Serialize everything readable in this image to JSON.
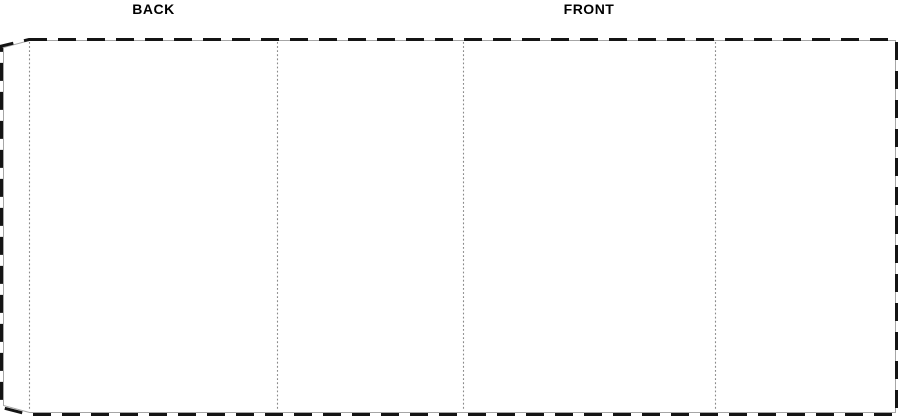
{
  "labels": {
    "back": "BACK",
    "front": "FRONT"
  },
  "colors": {
    "background": "#ffffff",
    "cut_dash": "#141414",
    "outline": "#a6a6a6",
    "fold_dots": "#8a8a8a",
    "label_text": "#000000"
  },
  "dieline": {
    "cut_path": "M29 39.5 L896.5 39.5 L896.5 414.5 L29 414.5 L1.5 407.5 L1.5 46 Z",
    "cut_dash_pattern": "18 11",
    "outline_path": "M29.5 40.5 L895.5 40.5 L895.5 412.5 L29.5 412.5 L3.5 405.5 L3.5 47.5 Z",
    "fold_dot_pattern": "1.8 2.3",
    "fold_paths": {
      "flap": "M29.5 42 L29.5 411",
      "fold1": "M277.5 42 L277.5 411",
      "fold2": "M463.5 42 L463.5 411",
      "fold3": "M715.5 42 L715.5 411"
    }
  }
}
